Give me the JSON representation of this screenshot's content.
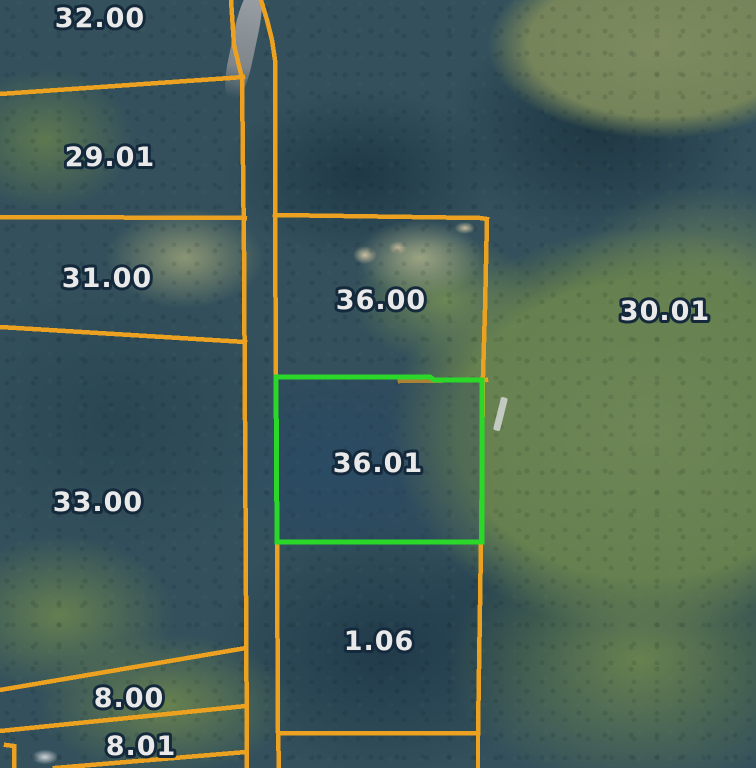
{
  "map": {
    "width": 756,
    "height": 768,
    "colors": {
      "boundary": "#ECA120",
      "highlight": "#2BD82A",
      "highlight_fill": "rgba(38,66,96,0.33)",
      "label_text": "#E9E9E9",
      "label_outline": "#142A3C"
    },
    "parcels": [
      {
        "id": "32-00",
        "label": "32.00",
        "x": 100,
        "y": 17,
        "highlighted": false
      },
      {
        "id": "29-01",
        "label": "29.01",
        "x": 110,
        "y": 156,
        "highlighted": false
      },
      {
        "id": "31-00",
        "label": "31.00",
        "x": 107,
        "y": 277,
        "highlighted": false
      },
      {
        "id": "33-00",
        "label": "33.00",
        "x": 98,
        "y": 501,
        "highlighted": false
      },
      {
        "id": "8-00",
        "label": "8.00",
        "x": 129,
        "y": 697,
        "highlighted": false
      },
      {
        "id": "8-01",
        "label": "8.01",
        "x": 141,
        "y": 745,
        "highlighted": false
      },
      {
        "id": "36-00",
        "label": "36.00",
        "x": 381,
        "y": 299,
        "highlighted": false
      },
      {
        "id": "30-01",
        "label": "30.01",
        "x": 665,
        "y": 310,
        "highlighted": false
      },
      {
        "id": "36-01",
        "label": "36.01",
        "x": 378,
        "y": 462,
        "highlighted": true
      },
      {
        "id": "1-06",
        "label": "1.06",
        "x": 379,
        "y": 640,
        "highlighted": false
      }
    ],
    "highlight_parcel": {
      "id": "36-01",
      "points": "276,377 430,377 434,380 482,380 482,542 277,542"
    },
    "boundaries": [
      {
        "name": "road-west-edge",
        "points": "231,0 234,45 242,78 244,250 245,420 247,768"
      },
      {
        "name": "road-east-edge",
        "points": "261,0 267,20 272,40 275,60 275,215 276,377 277,542 278,733 279,768"
      },
      {
        "name": "b-32-00-29-01",
        "points": "0,94 230,78 243,77"
      },
      {
        "name": "b-29-01-31-00",
        "points": "0,217 245,218"
      },
      {
        "name": "b-31-00-33-00",
        "points": "0,327 245,342"
      },
      {
        "name": "b-33-00-8-00",
        "points": "0,690 246,648"
      },
      {
        "name": "b-8-00-8-01",
        "points": "0,731 246,706"
      },
      {
        "name": "b-below-8-01",
        "points": "55,768 150,760 246,752"
      },
      {
        "name": "b-8-01-corner",
        "points": "6,745 14,746 14,768"
      },
      {
        "name": "p36-00-top",
        "points": "275,215 480,218 487,219"
      },
      {
        "name": "p36-00-right-edge",
        "points": "487,219 485,310 483,376 481,542 478,733 478,768"
      },
      {
        "name": "p36-00-bottom",
        "points": "400,381 486,380"
      },
      {
        "name": "p1-06-bottom",
        "points": "280,733 478,733"
      }
    ]
  }
}
